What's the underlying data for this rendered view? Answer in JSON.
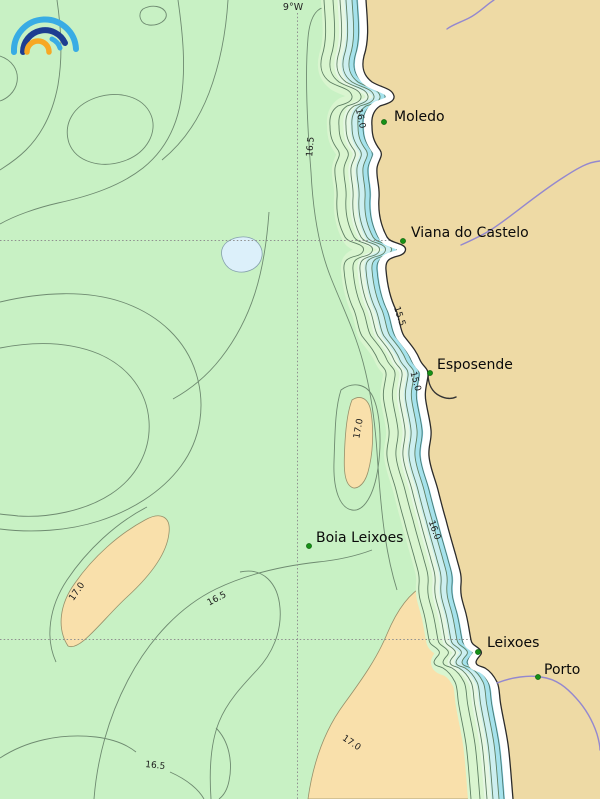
{
  "header": {
    "longitude_label": "9°W"
  },
  "places": [
    {
      "name": "Moledo"
    },
    {
      "name": "Viana do Castelo"
    },
    {
      "name": "Esposende"
    },
    {
      "name": "Boia Leixoes"
    },
    {
      "name": "Leixoes"
    },
    {
      "name": "Porto"
    }
  ],
  "isotherms": [
    {
      "label": "16.5"
    },
    {
      "label": "16.0"
    },
    {
      "label": "15.5"
    },
    {
      "label": "15.0"
    },
    {
      "label": "17.0"
    },
    {
      "label": "16.0"
    },
    {
      "label": "17.0"
    },
    {
      "label": "16.5"
    },
    {
      "label": "17.0"
    },
    {
      "label": "16.5"
    }
  ],
  "colors": {
    "sea": "#c8f1c4",
    "land": "#eedaa5",
    "warm_patch": "#f9e0ab",
    "cold_patch": "#dcf0fa",
    "coast_cyan": "#a5e2ec",
    "coast_blue": "#7fd0ea",
    "river": "#9488cf",
    "contour": "#6e8a70",
    "grid": "#8f8f8f",
    "city_marker": "#169016",
    "logo_light_blue": "#38ace4",
    "logo_dark_blue": "#1d3d91",
    "logo_orange": "#f7a823"
  }
}
